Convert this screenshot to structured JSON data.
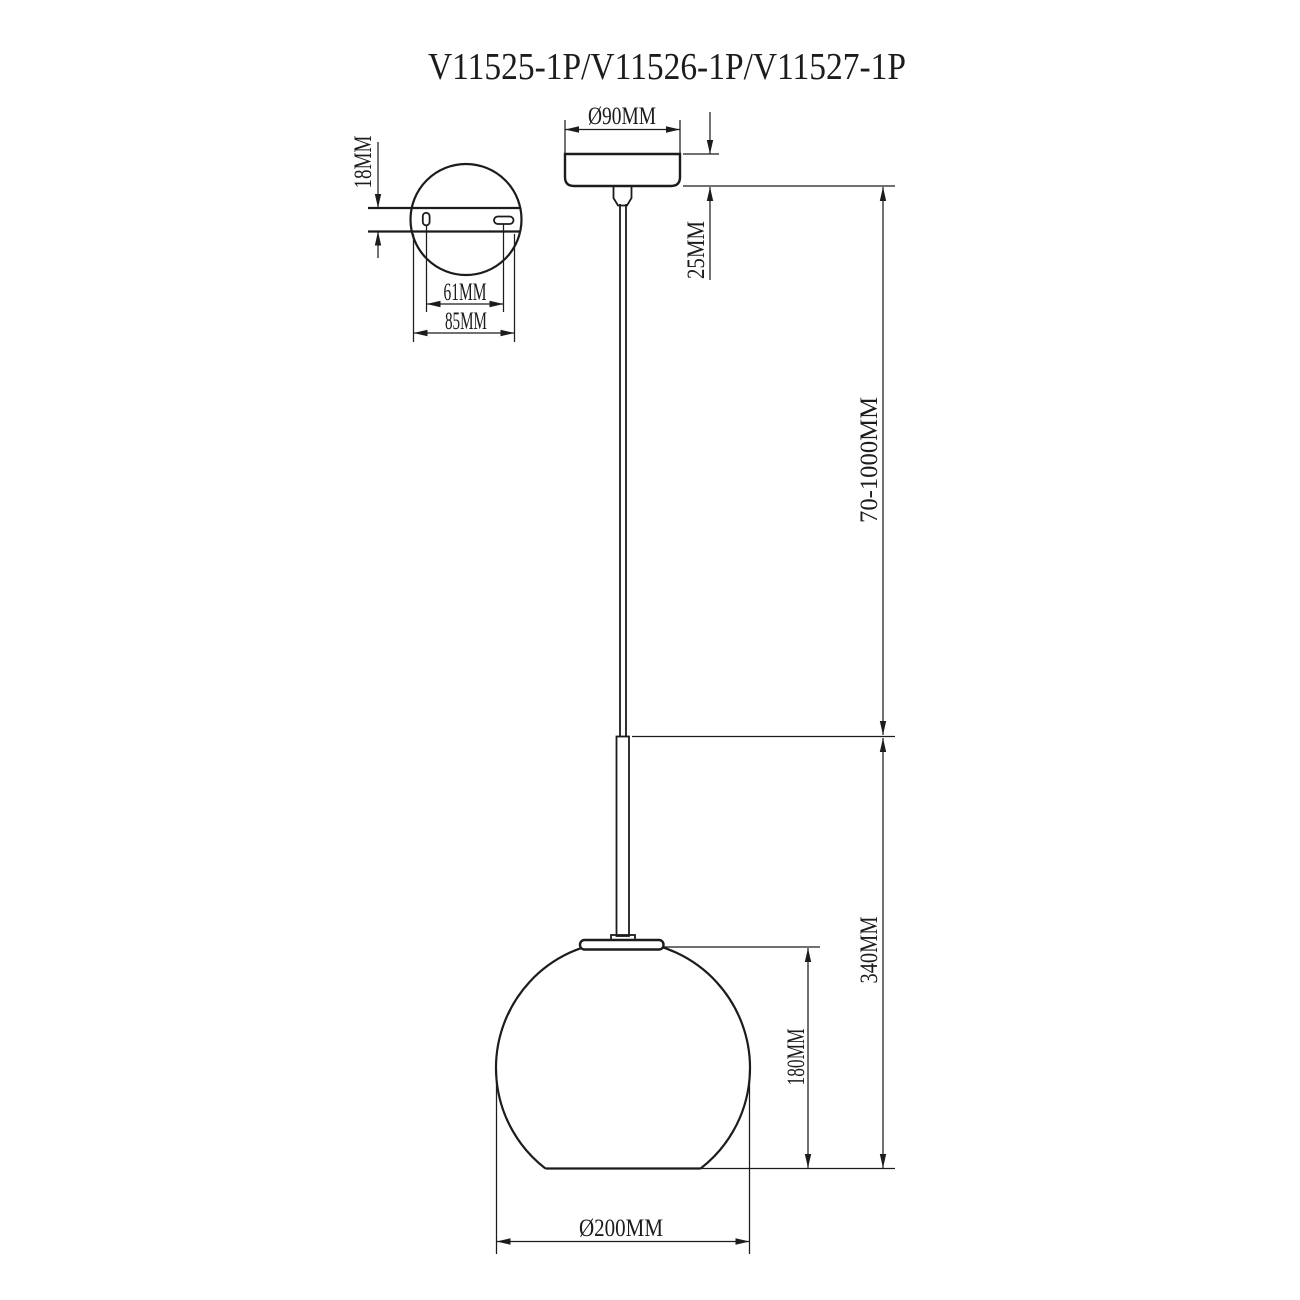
{
  "title": "V11525-1P/V11526-1P/V11527-1P",
  "colors": {
    "line": "#1c1c1c",
    "background": "#ffffff"
  },
  "mounting_plate_top_view": {
    "plate_thickness": "18MM",
    "hole_spacing": "61MM",
    "plate_width": "85MM"
  },
  "front_view": {
    "canopy_diameter": "Ø90MM",
    "canopy_height": "25MM",
    "suspension_length": "70-1000MM",
    "fixture_height": "340MM",
    "shade_height": "180MM",
    "shade_diameter": "Ø200MM"
  }
}
